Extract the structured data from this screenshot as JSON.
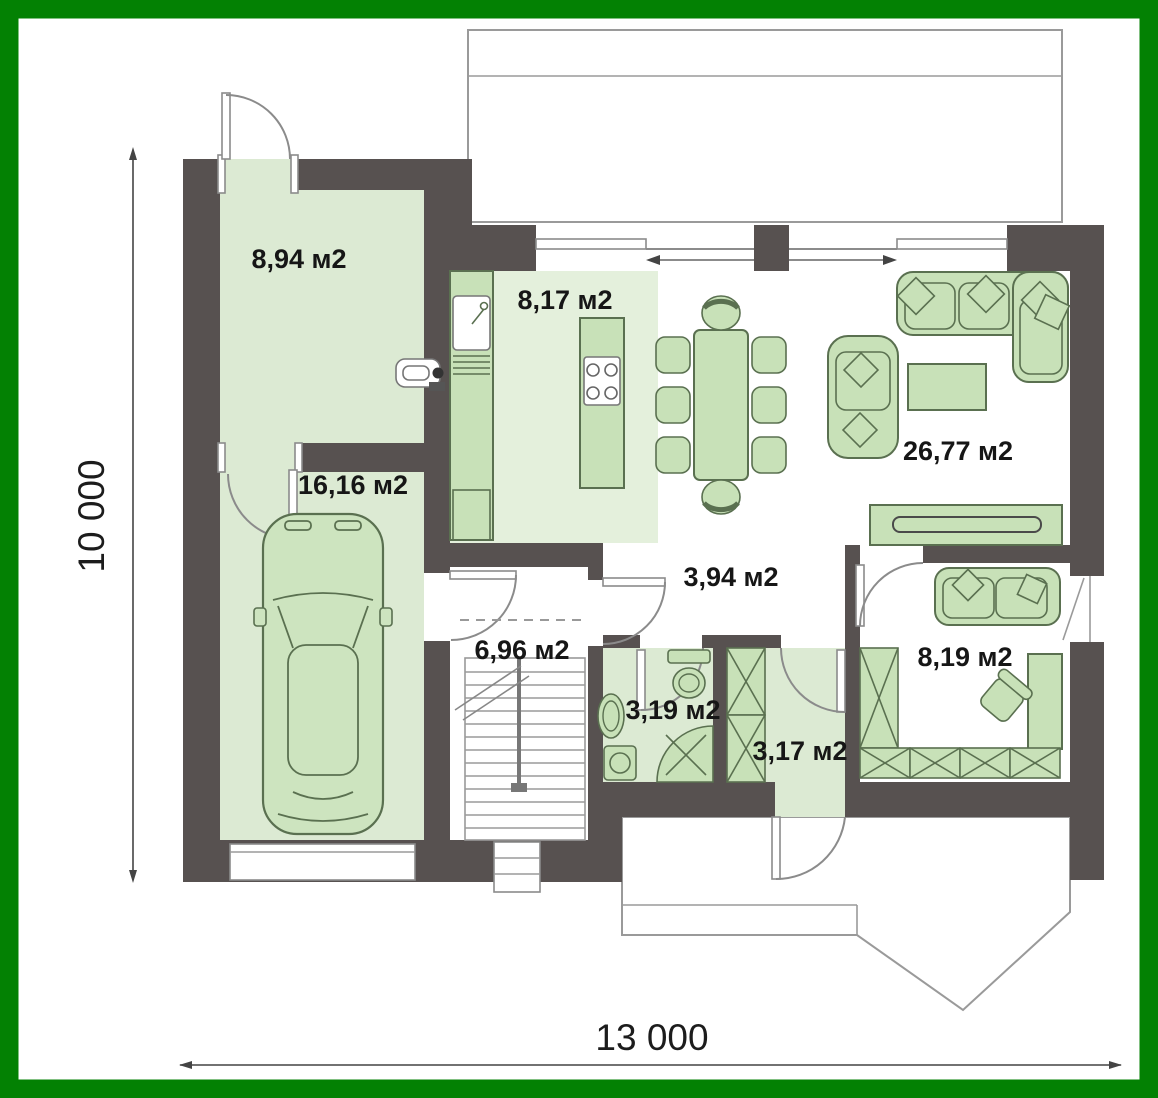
{
  "plan_title": "Ground floor plan",
  "rooms": [
    {
      "name": "entry-room",
      "area_label": "8,94 м2"
    },
    {
      "name": "kitchen",
      "area_label": "8,17 м2"
    },
    {
      "name": "garage",
      "area_label": "16,16 м2"
    },
    {
      "name": "living-dining",
      "area_label": "26,77 м2"
    },
    {
      "name": "hallway",
      "area_label": "3,94 м2"
    },
    {
      "name": "stair-hall",
      "area_label": "6,96 м2"
    },
    {
      "name": "bathroom",
      "area_label": "3,19 м2"
    },
    {
      "name": "entry-vestibule",
      "area_label": "3,17 м2"
    },
    {
      "name": "office",
      "area_label": "8,19 м2"
    }
  ],
  "dimensions": {
    "overall_width": "13 000",
    "overall_height": "10 000"
  },
  "colors": {
    "border": "#038103",
    "walls": "#575150",
    "room_fill": "#dcead3",
    "kitchen_fill": "#e4f0dc",
    "furniture_fill": "#c8e1b8",
    "furniture_stroke": "#5a7050",
    "label_text": "#161616",
    "outline_gray": "#9a9a9a"
  }
}
